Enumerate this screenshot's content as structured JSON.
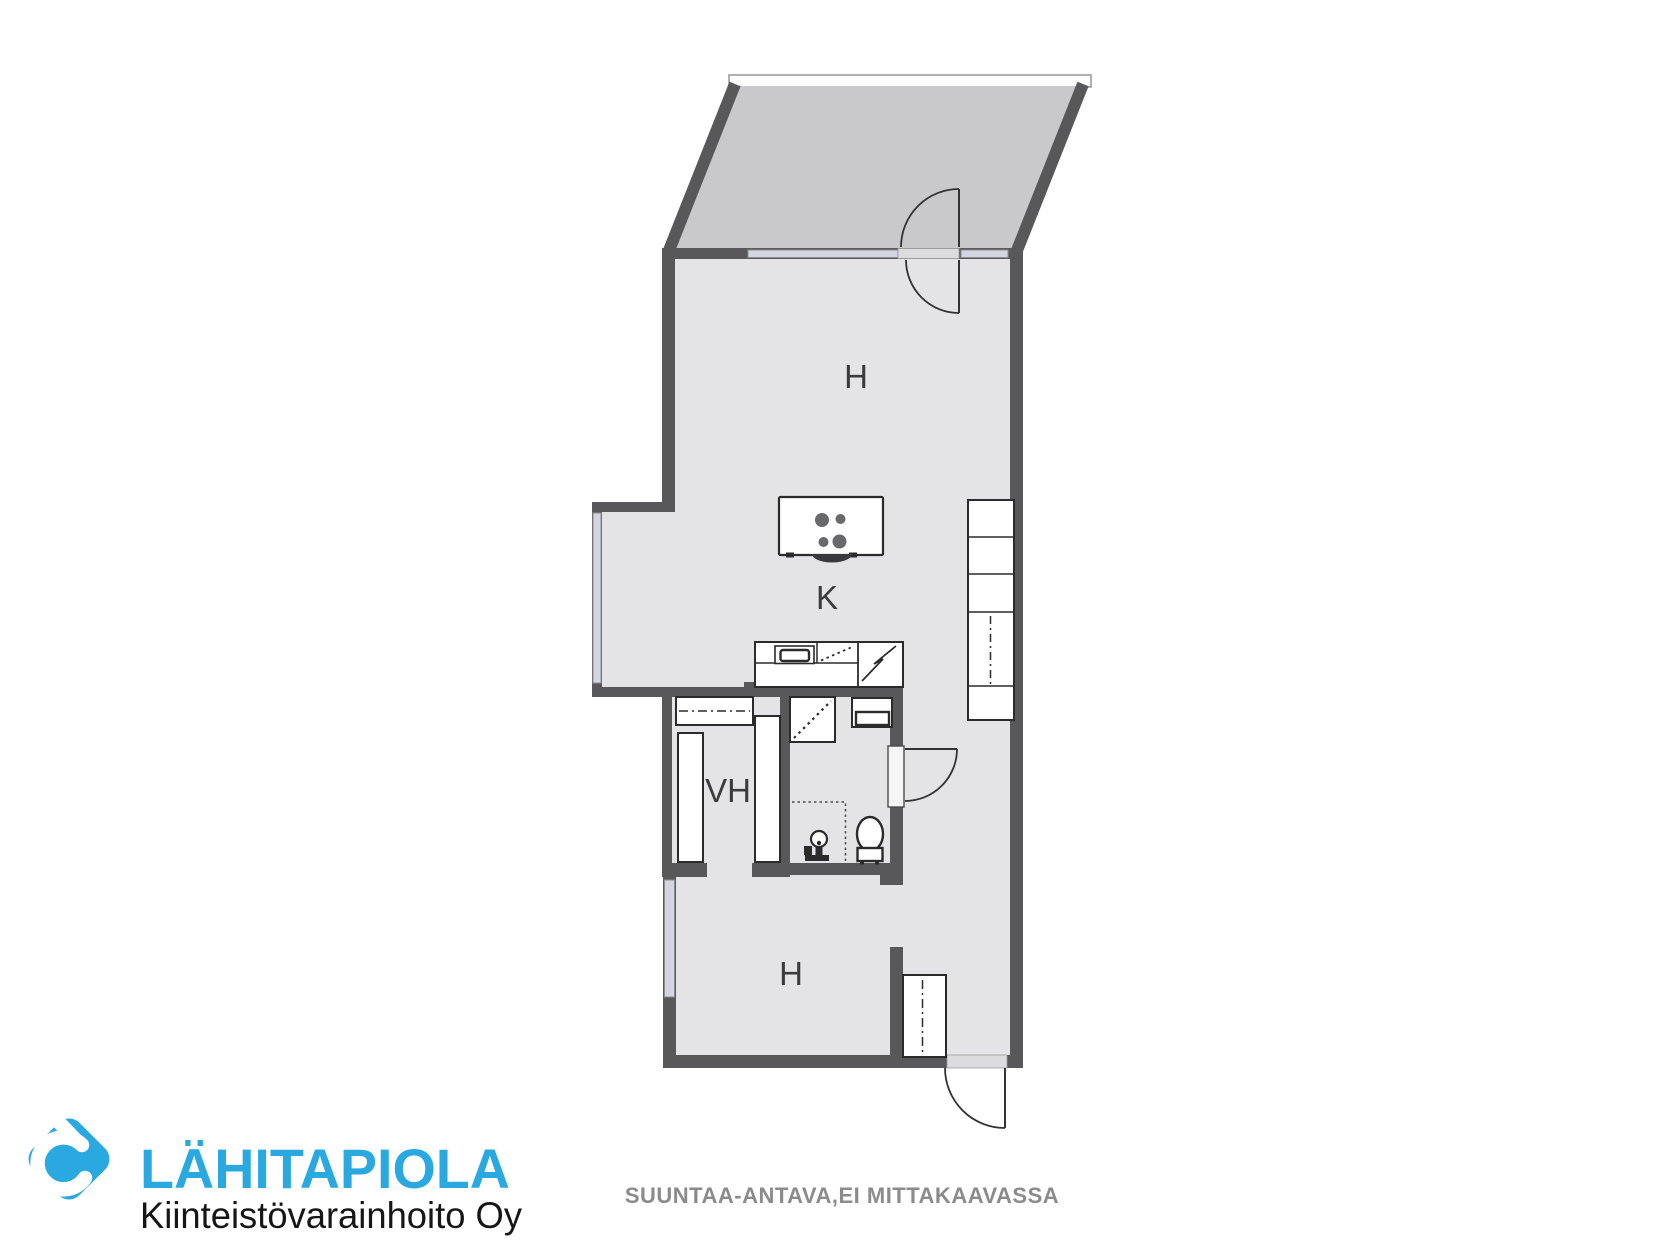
{
  "plan": {
    "room_labels": [
      {
        "id": "upper-room",
        "text": "H"
      },
      {
        "id": "kitchen",
        "text": "K"
      },
      {
        "id": "walk-in-closet",
        "text": "VH"
      },
      {
        "id": "lower-room",
        "text": "H"
      }
    ],
    "disclaimer": "SUUNTAA-ANTAVA,EI MITTAKAAVASSA",
    "symbols": [
      "stove-island-icon",
      "kitchen-sink-icon",
      "dishwasher-icon",
      "refrigerator-icon",
      "tall-cabinet-icon",
      "wardrobe-icon",
      "shower-icon",
      "washbasin-icon",
      "toilet-icon",
      "washing-machine-valve-icon",
      "door-swing-icon",
      "window-icon",
      "balcony-railing-icon"
    ],
    "colors": {
      "wall": "#58585A",
      "floor": "#E4E4E6",
      "balcony_floor": "#C9C9CB",
      "window_glass": "#D3D5E2",
      "threshold": "#DCDCDE",
      "label": "#3B3B3B",
      "note": "#8B8B8B"
    }
  },
  "branding": {
    "company": "LÄHITAPIOLA",
    "subtitle": "Kiinteistövarainhoito Oy",
    "brand_color": "#29A9E0",
    "logo_icon": "lahitapiola-diamond-icon"
  }
}
